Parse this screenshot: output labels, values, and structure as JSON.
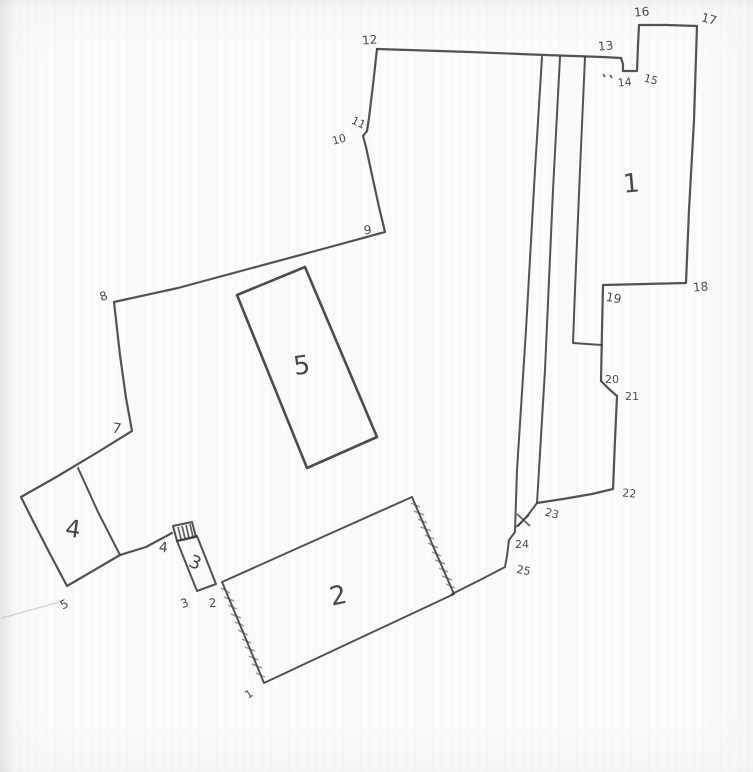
{
  "diagram": {
    "kind": "hand-drawn parcel boundary sketch",
    "colors": {
      "ink": "#3b3b3b",
      "paper": "#fbfbfa"
    }
  },
  "regions": {
    "r1": "1",
    "r2": "2",
    "r3": "3",
    "r4": "4",
    "r5": "5"
  },
  "vertices": {
    "v1": "1",
    "v2": "2",
    "v3": "3",
    "v4": "4",
    "v5": "5",
    "v7": "7",
    "v8": "8",
    "v9": "9",
    "v10": "10",
    "v11": "11",
    "v12": "12",
    "v13": "13",
    "v14": "14",
    "v15": "15",
    "v16": "16",
    "v17": "17",
    "v18": "18",
    "v19": "19",
    "v20": "20",
    "v21": "21",
    "v22": "22",
    "v23": "23",
    "v24": "24",
    "v25": "25"
  },
  "marks": {
    "x_mark": "x",
    "stray_dots": ".."
  }
}
